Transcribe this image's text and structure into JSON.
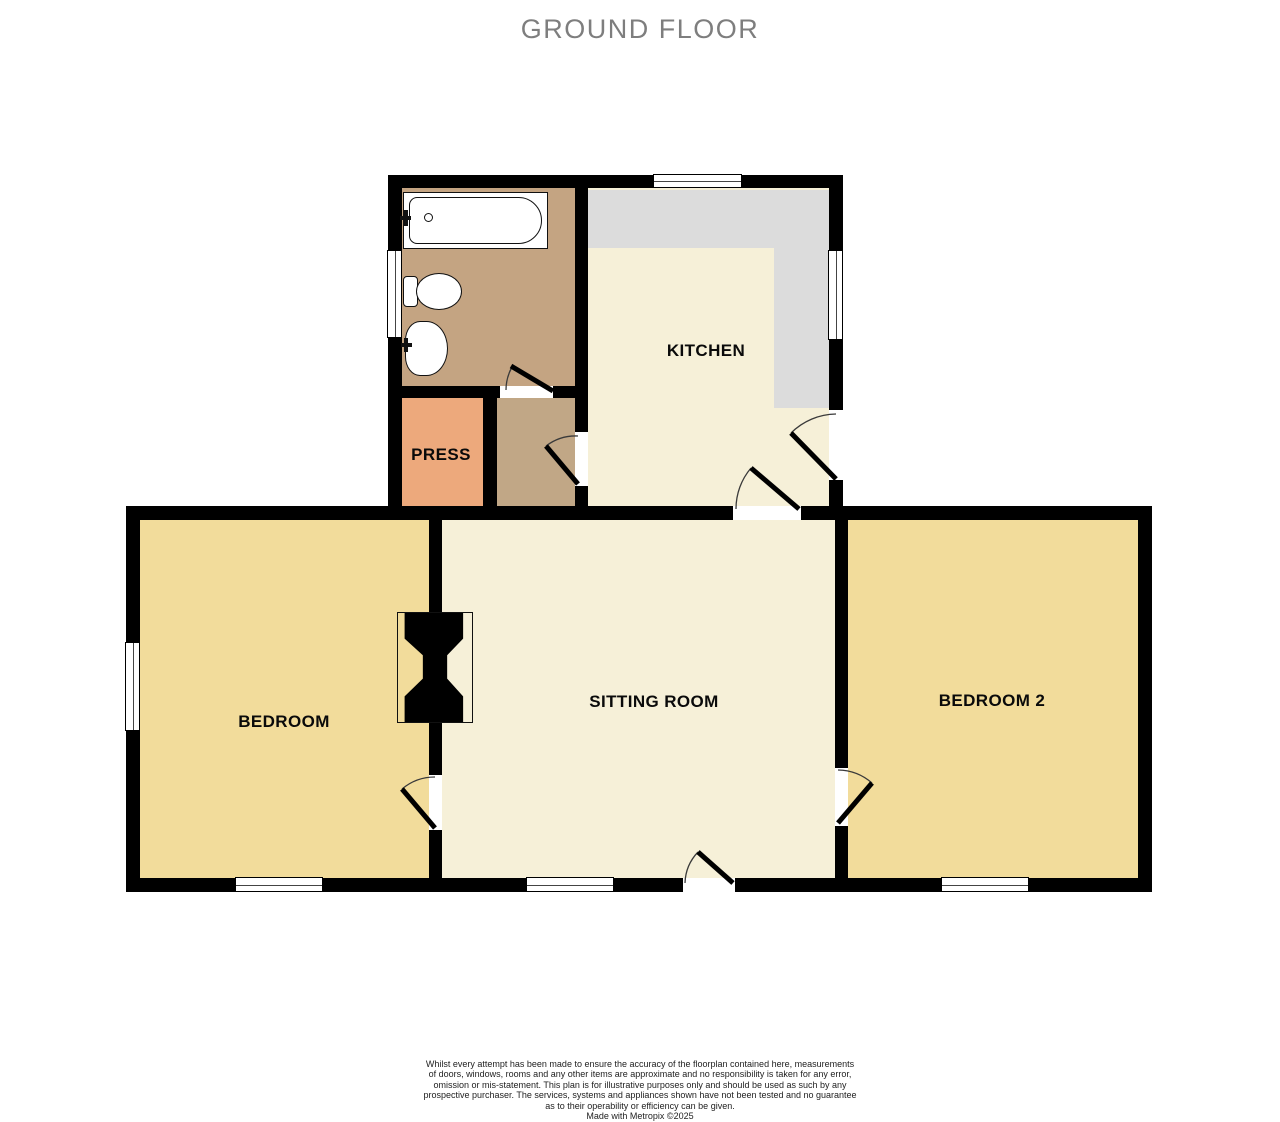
{
  "title": "GROUND FLOOR",
  "rooms": [
    {
      "name": "bedroom",
      "label": "BEDROOM"
    },
    {
      "name": "sitting-room",
      "label": "SITTING ROOM"
    },
    {
      "name": "bedroom-2",
      "label": "BEDROOM 2"
    },
    {
      "name": "kitchen",
      "label": "KITCHEN"
    },
    {
      "name": "press",
      "label": "PRESS"
    }
  ],
  "fixtures": {
    "bathroom": [
      "bathtub",
      "toilet",
      "wash-basin"
    ],
    "between-bedroom-and-sitting-room": [
      "chimney-breast"
    ],
    "kitchen": [
      "worktop-counter"
    ]
  },
  "colors": {
    "wall": "#000000",
    "bedroom_floor": "#f2dc9b",
    "sitting_kitchen_floor": "#f6f0d8",
    "bathroom_floor": "#c4a482",
    "hallway_floor": "#c1a786",
    "press_floor": "#eda97c",
    "worktop": "#dcdcdc",
    "title_text": "#7e7e7e"
  },
  "disclaimer": "Whilst every attempt has been made to ensure the accuracy of the floorplan contained here, measurements\nof doors, windows, rooms and any other items are approximate and no responsibility is taken for any error,\nomission or mis-statement. This plan is for illustrative purposes only and should be used as such by any\nprospective purchaser. The services, systems and appliances shown have not been tested and no guarantee\nas to their operability or efficiency can be given.",
  "credit": "Made with Metropix ©2025"
}
